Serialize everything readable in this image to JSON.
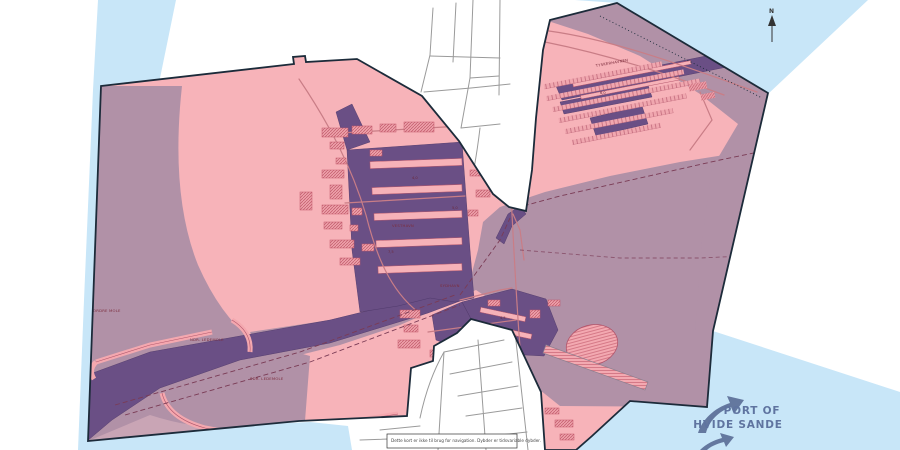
{
  "logo": {
    "line1": "PORT OF",
    "line2": "HVIDE SANDE"
  },
  "north_label": "N",
  "disclaimer": "Dette kort er ikke til brug for navigation. Dybder er tidsvariable dybder.",
  "labels": {
    "nordre_mole": "NORDRE MOLE",
    "ndr_ledemole": "NDR. LEDEMOLE",
    "sdr_ledemole": "SDR. LEDEMOLE",
    "vesthavn": "VESTHAVN",
    "sydhavn": "SYDHAVN",
    "tyskerhavnen": "TYSKERHAVNEN"
  },
  "soundings": [
    "7,5",
    "4,0",
    "5,0",
    "4,5",
    "6,0"
  ],
  "colors": {
    "sea_water": "#c8e6f8",
    "port_area_land": "#f7b3b9",
    "port_area_water": "#b191a7",
    "dredged_basin": "#6a4f85",
    "boundary": "#1c2b3a",
    "building": "#eda1aa",
    "building_hatch": "#c2596b",
    "logo_blue": "#5f74a0",
    "label_red": "#7c2d3d"
  }
}
